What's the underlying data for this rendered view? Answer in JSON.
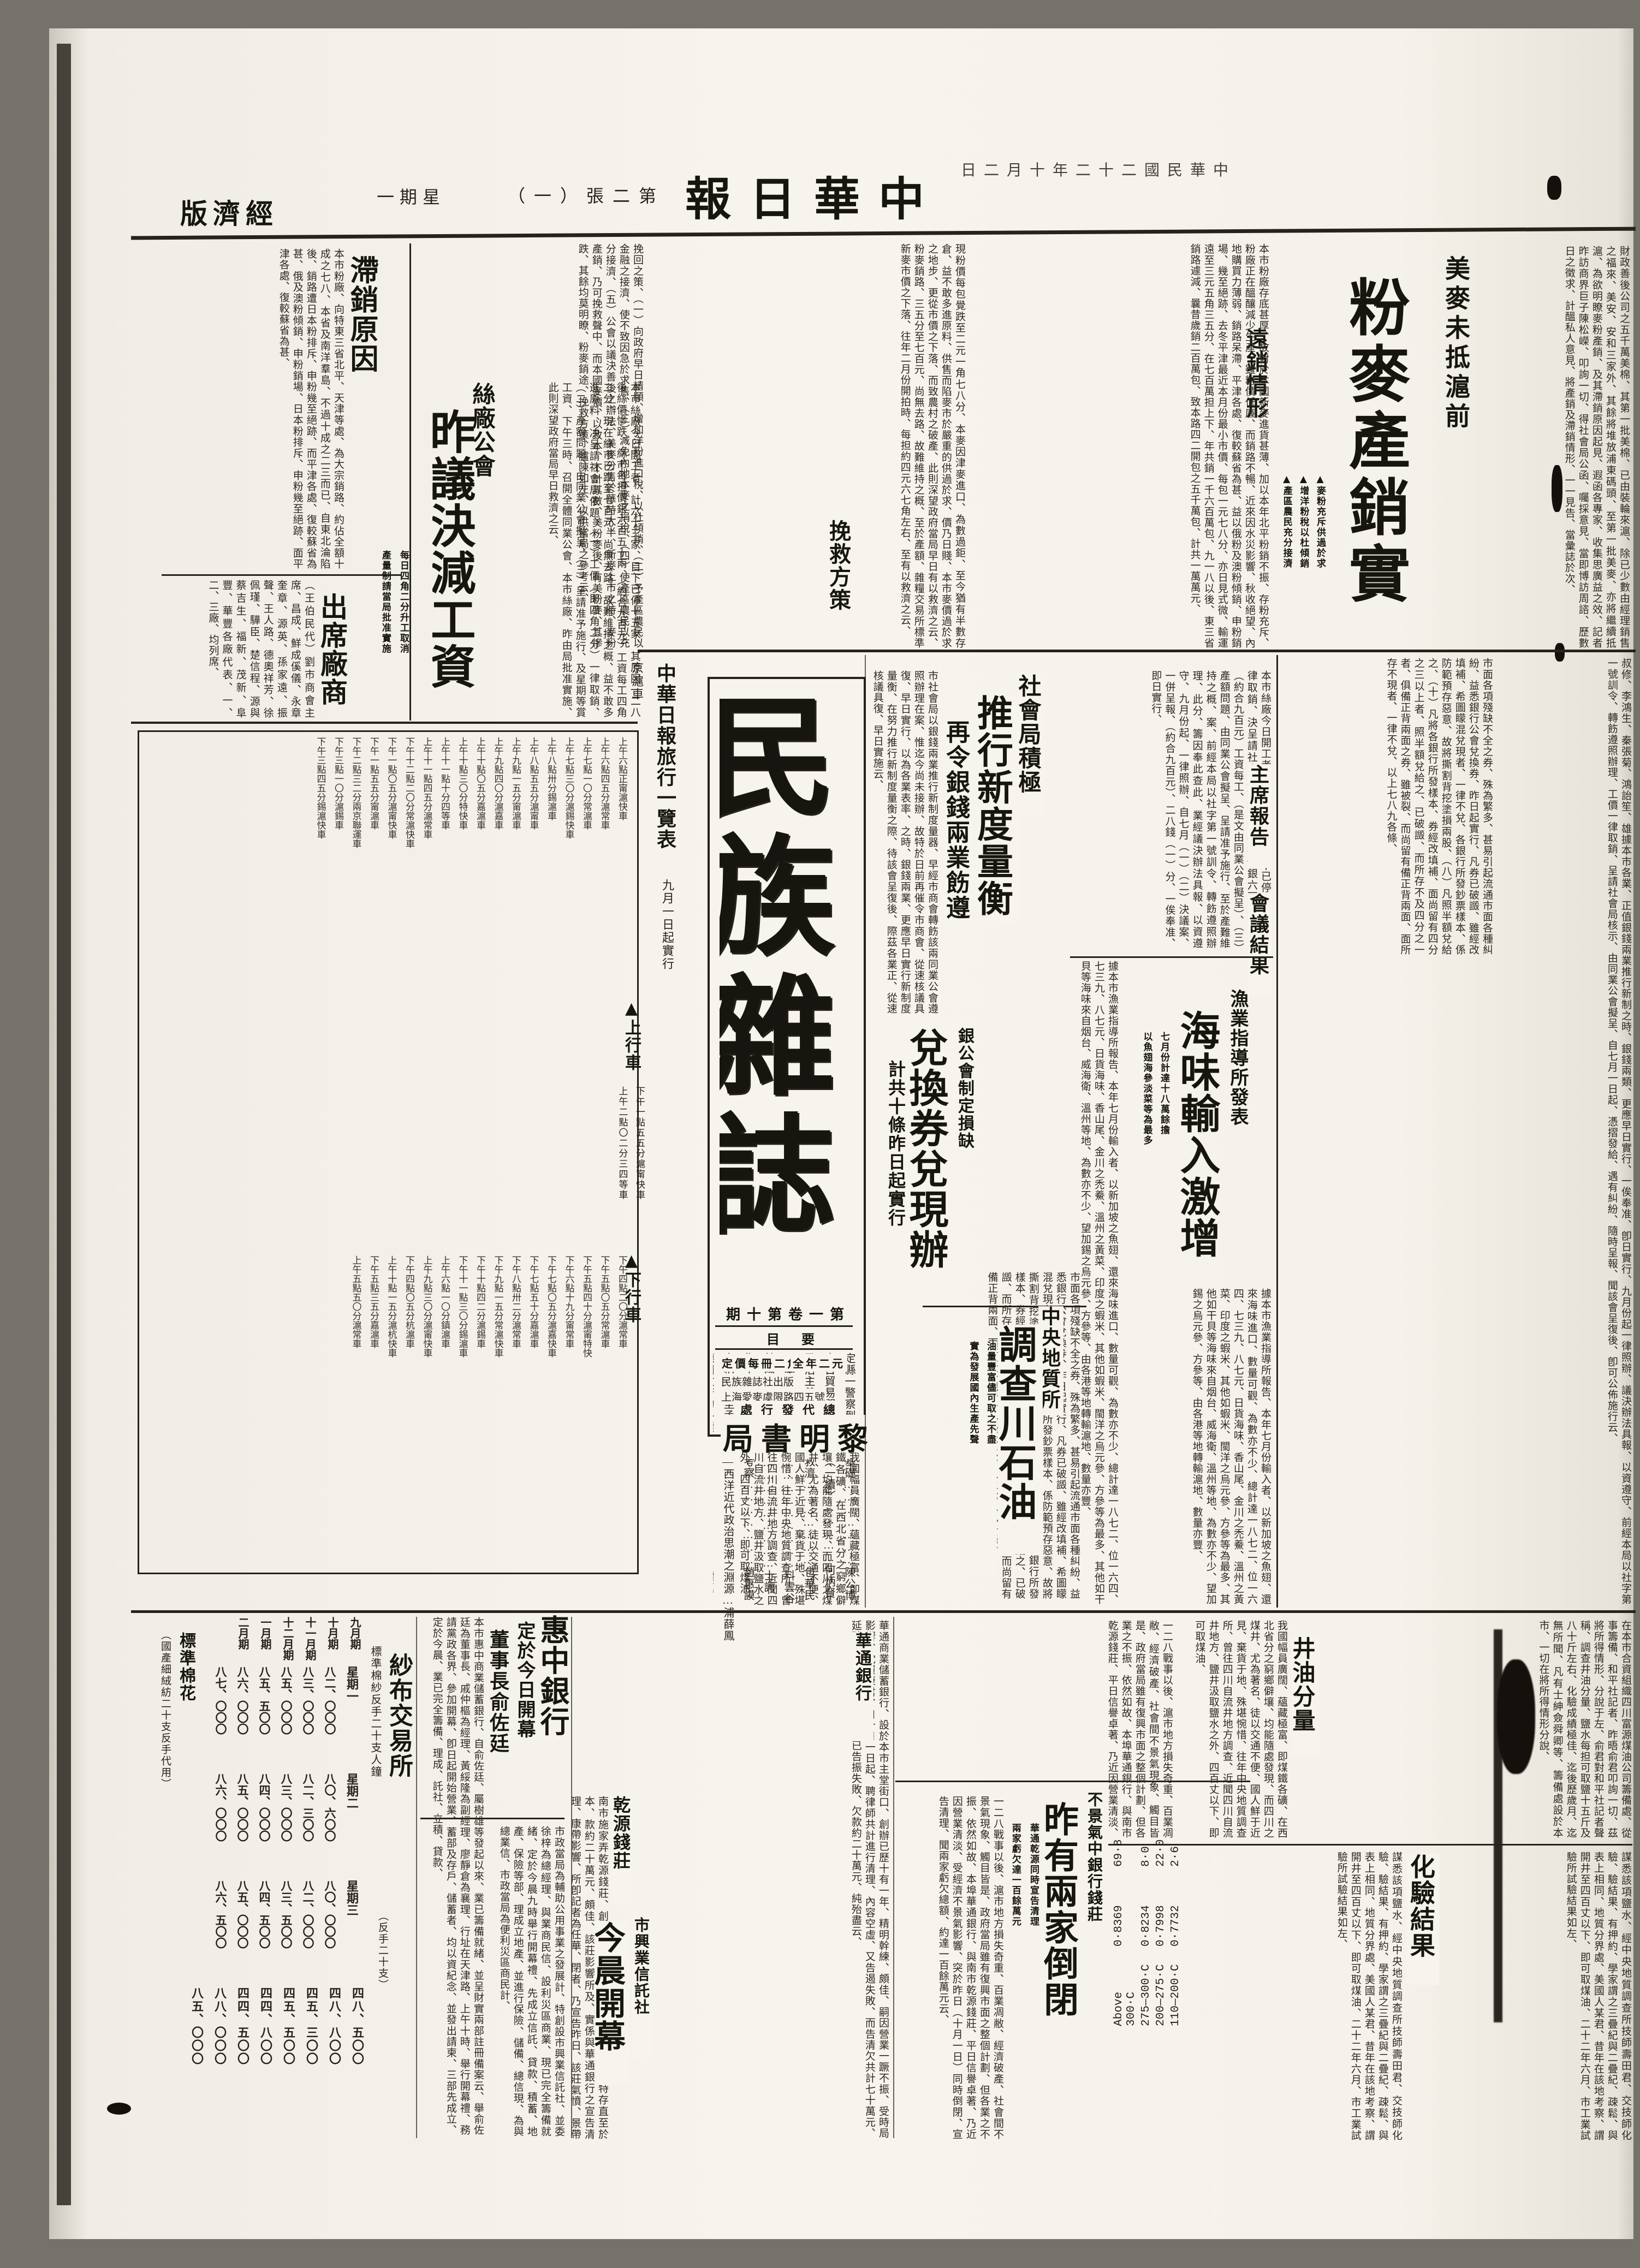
{
  "masthead": {
    "section_display": "版濟經",
    "date_display": "日二月十年二十二國民華中",
    "title_display": "報日華中",
    "edition_display": "（一）張二第",
    "weekday_display": "一期星"
  },
  "top_article": {
    "kicker": "美麥未抵滬前",
    "headline": "粉麥產銷實況",
    "subheads": [
      "▲麥粉充斥供過於求",
      "▲增洋粉稅以杜傾銷",
      "▲產區農民充分接濟"
    ],
    "section_head_1": "遠銷情形",
    "section_head_2": "挽救方策",
    "opening": "財政善後公司之五千萬美棉、其第一批美棉、已由裝輪來滬、除已少數由經理銷售之福來、美安、安和三家外、其餘將堆放浦東碼頭、至第一批美麥、亦將繼續抵滬、為欲明瞭麥粉產銷、及其滯銷原因起見、遐函各專家、收集思廣益之效、記者昨訪商界巨子陳松嶸、叩詢一切、得社會局公函、囑採意見、當即博訪周諮、歷數日之徵求、計醞私人意見、將產銷及滯銷情形、一一見告、當彙誌於次、",
    "body_a": "本市粉廠存底甚厚、故對於本國新麥進貨甚薄、加以本年北平粉銷不振、存粉充斥、粉廠正在醞釀減少生產、雖粉價低廉、而銷路不暢、近來因水災影響、秋收絕望、內地購買力薄弱、銷路呆滯、平津各處、復較蘇省為甚、益以俄粉及澳粉傾銷、申粉銷場、幾至絕跡、去冬平津最近本月份最小市價、每包一元七八分、亦日見式微、輸運遠至三元五角三五分、在七百萬担上下、年共銷一千六百萬包、九一八以後、東三省銷路遽減、曩昔歲銷二百萬包、致本路四二開包之五千萬包、計共一萬萬元、",
    "body_b": "現粉價每包覺跌至二元一角七八分、本麥因津麥進口、為數過鉅、至今猶有半數存倉、益不敢多進原料、供售而陷麥市於嚴重的供過於求、價乃日賤、本市麥價過於求之地步、更從市價之下落、而致農村之破產、此則深望政府當局早日有以救濟之云、粉麥銷路、三五分至七百元、尚無去路、故難維持之概、至於產額、雜糧交易所標準新麥市價之下落、往年二月份開拍時、每担約四元六七角左右、至有以救濟之云、",
    "body_c": "挽回之策、（一）向政府早日請願、增加洋粉進口稅、以杜傾銷、（二）予產區農民以金融之接濟、使不致因急於求售、（三）減免內地本麥之捐稅、（四）使產區農民以充分接濟、（五）公會以議決善後之辦法、美麥分售於華時大半、新麥上市之時、麥粉產銷、乃可挽救聲中、而本國麥價、以致本、不計其數、美粉麥後、有美粉麥、其慘跌、其餘均莫明瞭、粉麥銷途、挽救方策、臚陳如左、以供當局之參考云、"
  },
  "stagnation": {
    "head": "滯銷原因",
    "body": "本市粉廠、向特東三省北平、天津等處、為大宗銷路、約佔全額十成之七八、本省及南洋羣島、不過十成之二三而已、自東北淪陷後、銷路遭日本粉排斥、申粉幾至絕跡、而平津各處、復較蘇省為甚、俄及澳粉傾銷、申粉銷場、日本粉排斥、申粉幾至絕跡、面平津各處、復較蘇省為甚、"
  },
  "attendees": {
    "head": "出席廠商",
    "body": "（王伯民代）劉市商會主席、昌成、鮮成傒儀、永章奎章、源英、孫家遠、振聲、王人路、德奧祥芳、徐佩瑾、驊臣、楚信程、源與蔡吉生、福新、茂新、阜豐、華豐各廠代表、一、二、三廠、均列席、"
  },
  "silk": {
    "kicker": "絲廠公會",
    "headline": "昨議決減工資",
    "subheads": [
      "每日四角二分升工取消",
      "產量制請當局批准實施"
    ],
    "body": "本市絲廠今日開工者、計六十三家、目下已停十五家、其原因一二八後絲價慘跌、絲市每担價銀六百五十兩、（約合九百元）工資每工四角二分、現在絲市已跌至七百元、尚無去路、故難維持之概、益不敢多進原料、决呈請社會局依題、（一）工價（即四角二分）一律取銷、（二）產額問題、由同業公會擬呈、（三）呈請准予施行、及星期等賞工資、下午三時、召開全體同業公會、本市絲廠、昨由局批准實施、此則深望政府當局早日救濟之云、"
  },
  "bureau": {
    "kicker": "社會局積極",
    "headline": "推行新度量衡",
    "subhead": "再令銀錢兩業飭遵",
    "body": "市社會局以銀錢兩業推行新制度量器、早經市商會轉飭該兩同業公會遵照辦理在案、惟迄今尚未接辦、故特於日前再催令市商會、從速核議具復、早日實行、以為各業表率、之時、銀錢兩業、更應早日實行新制度量衡、在努力推行新制度量衡之際、待該會呈復後、際茲各業正、從速核議具復、早日實施云、"
  },
  "meeting": {
    "report_head": "主席報告",
    "result_head": "會議結果",
    "body": "本市絲廠今日開工者、計六十三家、目下已停十五家、一律取銷、決呈請社會局依題、市每担價銀六百五十兩、（約合九百元）工資每工、（是文由同業公會擬呈）、（三）產額問題、由同業公會擬呈、呈請准予施行、至於產難維持之概、案、前經本局以社字第一號訓令、轉飭遵照辦理、此分、籌因奉此查此、業經議決辦法具報、以資遵守、九月份起、一律照辦、自七月（一）（二）決議案、一併呈報、（約合九百元）、二八錢（一）分、一俟奉准、即日實行、",
    "names": "叔修、李鴻生、秦張菊、鴻詒笙、雄據本市各業、正值銀錢兩業推行新制之時、銀錢兩類、更應早日實行、一俟奉准、卽日實行、九月份起一律照辦、議決辦法具報、以資遵守、前經本局以社字第一號訓令、轉飭遵照辦理、工價一律取銷、呈請社會局核示、由同業公會擬呈、自七月一日起、憑摺發給、遇有糾紛、隨時呈報、聞該會呈復後、卽可公佈施行云、"
  },
  "fishery": {
    "kicker": "漁業指導所發表",
    "headline": "海味輸入激增",
    "subheads": [
      "七月份計達十八萬餘擔",
      "以魚翅海參淡菜等為最多"
    ],
    "body": "據本市漁業指導所報告、本年七月份輸入者、以新加坡之魚翅、還來海味進口、數量可觀、為數亦不少、總計達一八七二、位一六四、七三九、八七元、日貨海味、香山尾、金川之禿鯗、溫州之黃菜、印度之蝦米、其他如蝦米、閩洋之烏元參、方參等為最多、其他如干貝等海味來自烟台、威海衛、溫州等地、為數亦不少、望加錫之烏元參、方參等、由各港等地轉輸滬地、數量亦豐、"
  },
  "exchange": {
    "kicker": "銀公會制定損缺",
    "headline": "兌換券兌現辦法",
    "subhead": "計共十條昨日起實行",
    "body": "市面各項殘缺不全之券、殊為繁多、甚易引起流通市面各種糾紛、益悉銀行公會兌換券、昨日起實行、凡券已破譭、雖經改填補、希圖矇混兌現者、一律不兌、各銀行所發鈔票樣本、係防範預存惡意、故將撕割背挖塗損兩股、（八）凡照半額兌給之、（十）凡將各銀行所發樣本、券經改填補、面尚留有四分之三以上者、照半額兌給之、已破譭、而所存不及四分之一者、俱備正背兩面之券、雖被裂、而尚留有備正背兩面、面所存不現者、一律不兌、以上七八九各條、"
  },
  "geology": {
    "kicker": "中央地質所",
    "headline": "調查川石油礦",
    "subheads": [
      "油量豐富儘可取之不盡",
      "實為發展國內生產先聲"
    ],
    "body": "我國幅員廣闊、蘊藏極富、即煤鐵各礦、在西北省分之窮鄉僻壤、均能隨處發現、而四川之煤井、尤為著名、徒以交通不便、國人鮮于近見、棄貨于地、殊堪惋惜、往年中央地質調查所、曾往四川自流井地方調查、近聞四川自流井地方、鹽井汲取鹽水之外、四百丈以下、即可取煤油、",
    "oil_head": "井油分量",
    "oil_body": "在本市合資組織四川富源煤油公司籌備處、從事籌備、和平社記者、昨晤俞君叩詢一切、茲將所得情形、分說于左、俞君對和平社記者聲稱、調查井油分量、鹽水每担可取鹽十五斤及八十斤左右、化驗成績極佳、迄後歷歲月、迄無所聞、凡有士紳僉舜卿等、籌備處設於本市、一切在將所得情形分說、",
    "assay_head": "化驗結果",
    "assay_body": "謀悉該項鹽水、經中央地質調查所技師壽田君、交技師化驗、驗結果、有押約、學家謂之三疊紀與二疊紀、疎鬆、與表上相同、地質分界處、美國人某君、昔年在該地考察、謂開井至四百丈以下、即可取煤油、二十二年六月、市工業試驗所試驗結果如左、",
    "table": [
      [
        "Above 300·C",
        "0·8369",
        "69·8"
      ],
      [
        "275—300·C",
        "0·8234",
        "8·0"
      ],
      [
        "200—275·C",
        "0·7998",
        "22·0"
      ],
      [
        "110—200·C",
        "0·7732",
        "2·6"
      ]
    ]
  },
  "closures": {
    "kicker": "不景氣中銀行錢莊",
    "headline": "昨有兩家倒閉",
    "subheads": [
      "華通乾源同時宣告清理",
      "兩家虧欠達一百餘萬元"
    ],
    "body": "一二八戰事以後、滬市地方損失奇重、百業凋敝、經濟破產、社會間不景氣現象、觸目皆是、政府當局雖有復興市面之整個計劃、但各業之不振、依然如故、本埠華通銀行、與南市乾源錢莊、平日信譽卓著、乃近因營業清淡、受經濟不景氣影響、突於昨日（十月一日）同時倒閉、宣告清理、聞兩家虧欠總額、約達一百餘萬元云、",
    "huatong_head": "華通銀行",
    "huatong_body": "華通商業儲蓄銀行、設於本市主堂街口、創辦已歷十有一年、精明幹練、頗佳、嗣因營業一蹶不振、受時局影響、沈履康君、自十月一日起、聘律師共計進行清理、內容空虛、又告遏失敗、而告清欠共計七十萬元、延聘律師、價內容一空、已告振失敗、欠款約二十萬元、純殆盡云、",
    "qianyuan_head": "乾源錢莊",
    "qianyuan_body": "南市施家弄乾源錢莊、創辦業已四十餘年、資本十萬元、特存直至於本、款約二十萬元、頗佳、該莊影響所及、實係與華通銀行之宣告清理、康帶影響、所卽記者為任華、閉者、乃宣告昨日、該莊氣憤、景帶影響、善後辦法云、已由各股十則餘同達五因其受、經萬、有至元、"
  },
  "huizhong": {
    "headline": "惠中銀行",
    "sub1": "定於今日開幕",
    "sub2": "董事長俞佐廷",
    "body": "本市惠中商業儲蓄銀行、自俞佐廷、屬樹雄等發起以來、業已籌備就緒、並呈財實兩部註冊備案云、舉俞佐廷為董事長、戚仲樞為經理、黃綏隆為副經理、廖靜倉為襄理、行址在天津路、上午十時、舉行開幕禮、務請黨政各界、參加開幕、卽日起開始營業、蓄部及存戶、儲蓄者、均以資紀念、並發出請柬、三部先成立、定於今晨、業已完全籌備、理成、託社、立積、貸款、"
  },
  "trust": {
    "headline": "市興業信託社",
    "sub": "今晨開幕",
    "body": "市政當局為輔助公用事業之發展計、特創設市興業信託社、並委徐梓為總經理、與業商民信、設利災區商業、現已完全籌備就緒、定於今晨九時舉行開幕禮、先成立信託、貸款、積蓄、地產、保險等部、理成立地產、並進行保險、儲備、總信現、為與總業信、市政當局為便利災區商民計、"
  },
  "yarn": {
    "head": "紗布交易所",
    "sub": "標準棉紗反手二十支人鐘",
    "note": "（反手二十支）",
    "months": [
      "九月期",
      "十月期",
      "十一月期",
      "十二月期",
      "一月期",
      "二月期"
    ],
    "groups": [
      {
        "label": "星期一",
        "prices": [
          "八二、〇〇〇",
          "八三、〇〇〇",
          "八五、〇〇〇",
          "八五、五〇〇",
          "八六、〇〇〇",
          "八七、〇〇〇"
        ]
      },
      {
        "label": "星期二",
        "prices": [
          "八〇、六〇〇",
          "八二、三〇〇",
          "八三、〇〇〇",
          "八四、〇〇〇",
          "八五、〇〇〇",
          "八六、〇〇〇"
        ]
      },
      {
        "label": "星期三",
        "prices": [
          "八〇、〇〇〇",
          "八二、〇〇〇",
          "八三、五〇〇",
          "八四、五〇〇",
          "八五、〇〇〇",
          "八六、五〇〇"
        ]
      }
    ],
    "cotton_label": "標準棉花",
    "cotton_note": "（國產細絨紡二十支反手代用）",
    "cotton_quotes": [
      "四八、五〇〇",
      "四八、八〇〇",
      "四五、三〇〇",
      "四五、五〇〇",
      "四四、八〇〇",
      "四四、五〇〇",
      "八八、〇〇〇",
      "八五、〇〇〇"
    ]
  },
  "magazine": {
    "title": "民族雜誌",
    "issue_display": "期十第卷一第",
    "toc_label_display": "目要",
    "toc": [
      "定縣一警察到社會的基礎…………………陳公博",
      "中日貿易問題的研究（一續）……………何炳賢",
      "民治主義之衰落及其救濟…………………包華民",
      "日本底最近的動向…………………………料雲谷",
      "美國之實業復興案…………………………士諤",
      "集中上海之數字上的考察…………………趙惠謨",
      "自柏拉圖至孟德斯鳩—西洋近代政治思潮之淵源…浦薛鳳",
      "德國政府的外債……………………………謝惠",
      "山東博山之紅土工業………………………陳公博",
      "國外通訊……………………………………"
    ],
    "price_line1": "定價每冊二角",
    "price_line2": "全年二元",
    "pub_line1": "民族雜誌社出版",
    "pub_line2": "上海愛麥虞限路四五號",
    "dist_label_display": "處行發代總",
    "dist_display": "局書明黎"
  },
  "timetable": {
    "title": "中華日報旅行一覽表",
    "note": "九月一日起實行",
    "line": "京滬車",
    "up": "▲上行車",
    "down": "▲下行車",
    "entries_side": [
      "下午一點五五分滬甯快車",
      "上午二點〇二分三四等車",
      "下午二點三二分兩京聯運快車",
      "下午八點卅二分滬常車",
      "下午六點十九分甯常車",
      "下午十點四二分滬錫車"
    ],
    "entries_up": [
      "上午六點正甯滬快車",
      "上午六點四五分滬常車",
      "上午七點一〇分常滬車",
      "上午七點三〇分滬錫快車",
      "上午八點卅分錫滬車",
      "上午八點五五分滬甯車",
      "上午九點一五分甯滬車",
      "上午九點四〇分滬嘉車",
      "上午十點〇五分嘉滬車",
      "上午十點三〇分特快車",
      "上午十一點十分四等車",
      "上午十一點四五分滬常車",
      "下午十二點二〇分常滬快車",
      "下午一點〇五分滬甯快車",
      "下午一點五五分甯滬車",
      "下午二點三二分兩京聯運車",
      "下午三點一〇分滬錫車",
      "下午三點四五分錫滬快車"
    ],
    "entries_down": [
      "下午四點二〇分滬常車",
      "下午五點〇五分常滬車",
      "下午五點四十分滬甯特快",
      "下午六點十九分甯常車",
      "下午七點〇五分滬嘉快車",
      "下午七點五十分嘉滬車",
      "下午八點卅二分滬常車",
      "下午九點一五分常滬快車",
      "下午十點四二分滬錫車",
      "下午十一點三〇分錫滬車",
      "上午六點一〇分鎮滬車",
      "上午九點三〇分滬甯快車",
      "下午四點〇五分杭滬車",
      "上午十點一五分滬杭快車",
      "下午五點三五分嘉滬車",
      "上午五點五〇分滬常車"
    ]
  }
}
